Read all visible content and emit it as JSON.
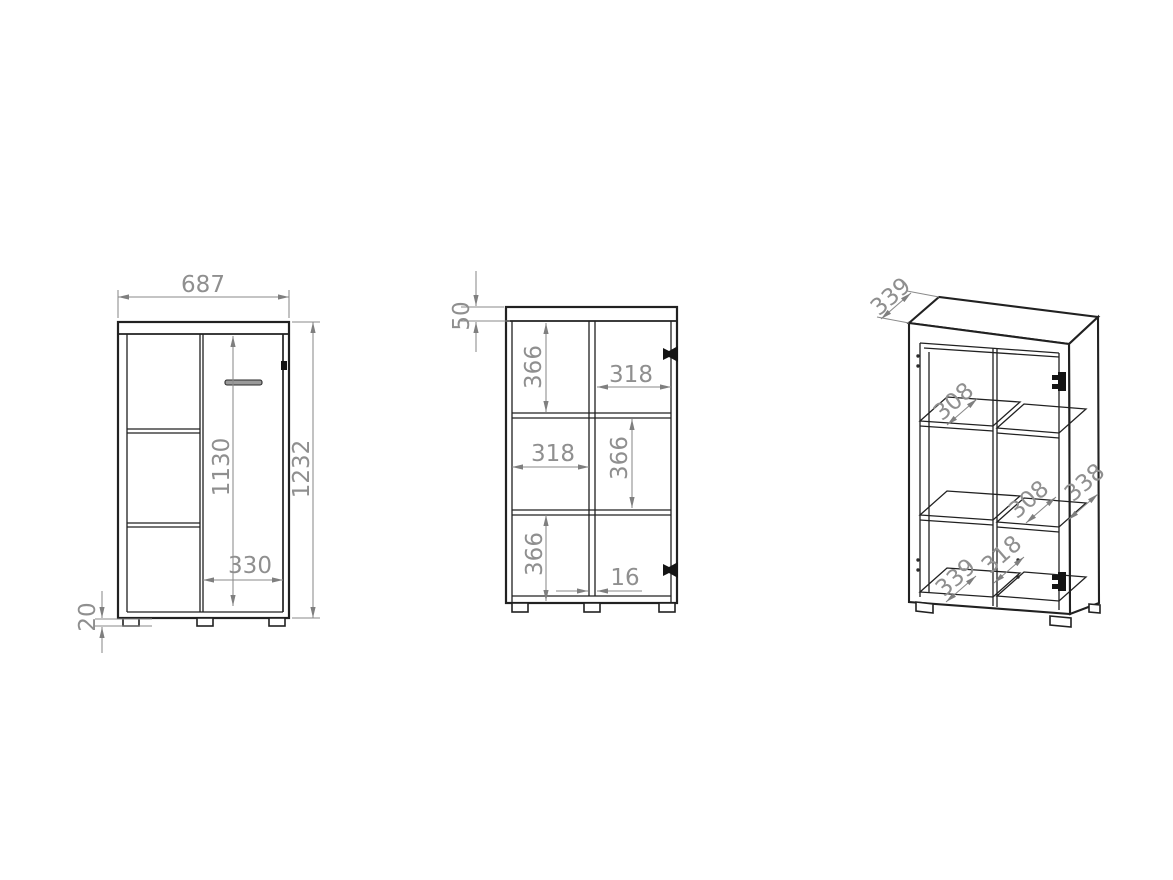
{
  "colors": {
    "background": "#ffffff",
    "object_line": "#212121",
    "dimension_line": "#8a8a8a",
    "dimension_text": "#8f8f8f",
    "hinge": "#141414"
  },
  "views": {
    "front": {
      "dims": {
        "width": "687",
        "height": "1232",
        "door_height": "1130",
        "door_width": "330",
        "foot_height": "20"
      }
    },
    "section": {
      "dims": {
        "top_panel": "50",
        "top_left_cell_height": "366",
        "top_right_cell_width": "318",
        "mid_left_cell_width": "318",
        "mid_right_cell_height": "366",
        "bottom_left_cell_height": "366",
        "divider_thickness": "16"
      }
    },
    "perspective": {
      "dims": {
        "top_depth": "339",
        "top_shelf_depth": "308",
        "mid_shelf_depth": "308",
        "side_depth": "338",
        "bottom_inner_width": "318",
        "bottom_depth": "339"
      }
    }
  }
}
